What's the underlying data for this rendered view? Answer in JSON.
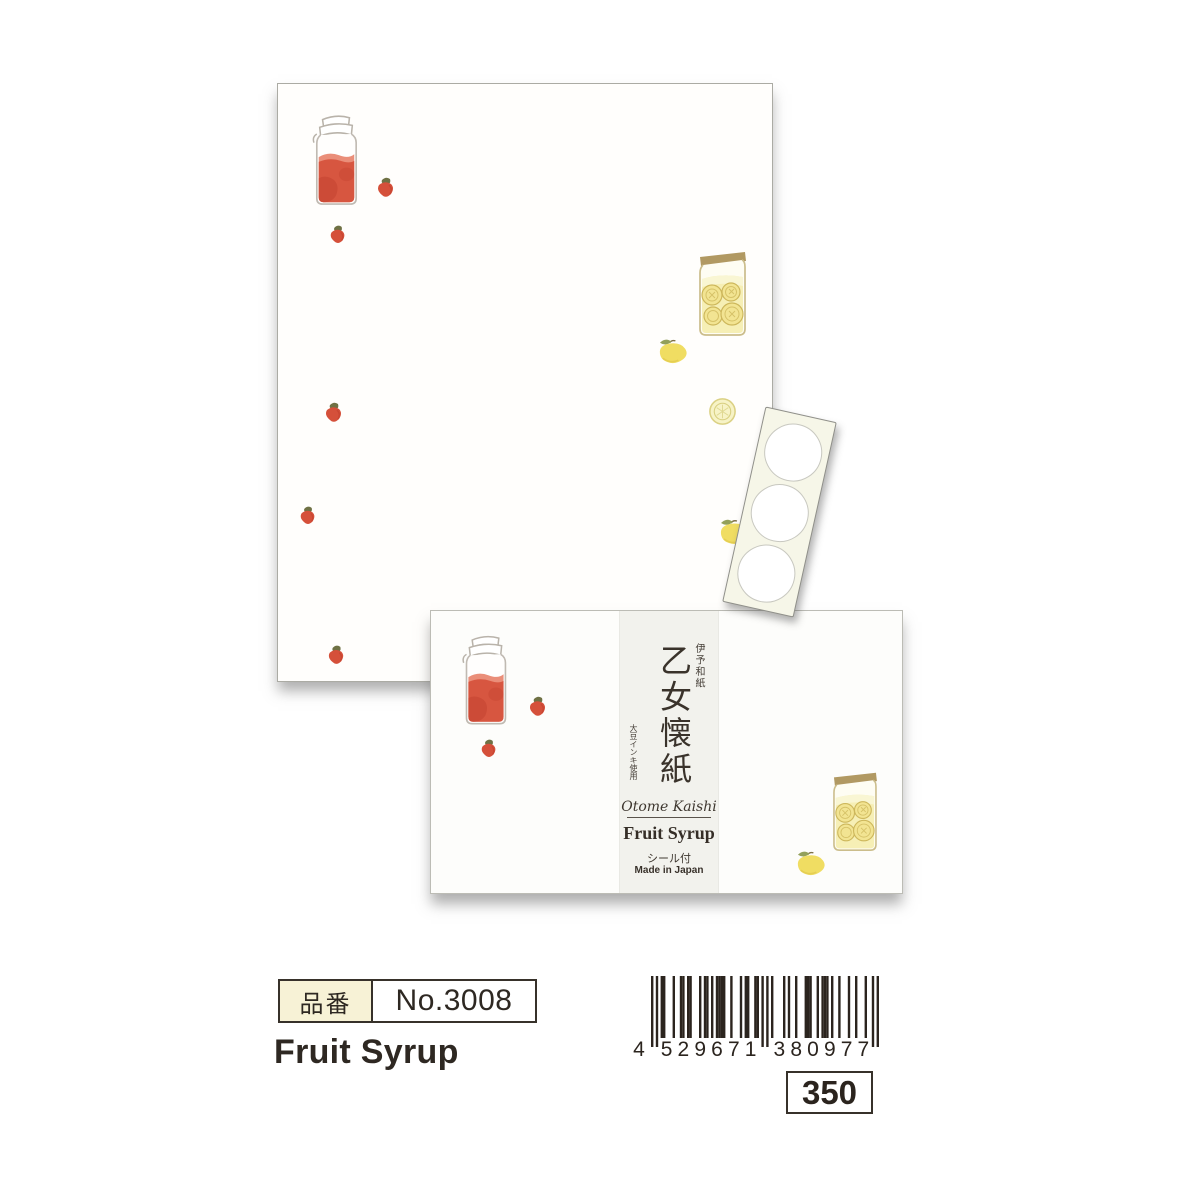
{
  "page": {
    "background": "#ffffff"
  },
  "colors": {
    "page_bg": "#ffffff",
    "red": "#d5503a",
    "red_deep": "#c13f2d",
    "red_light": "#e57258",
    "berry_leaf": "#6f7144",
    "lemon_yellow": "#f0dd62",
    "lemon_pale": "#f6efb5",
    "slice_yellow": "#f2e492",
    "slice_line": "#cdb75b",
    "leaf_green": "#93a05b",
    "lid_brown": "#aa9055",
    "jar_outline": "#b9b3aa",
    "ljar_outline": "#cbbd8b",
    "band_bg": "#f2f2ed",
    "cream": "#f7f2d6",
    "ink": "#2b241e",
    "text_dark": "#37302a"
  },
  "illustrations": {
    "strawberry_jar": "strawberry-syrup-jar",
    "lemon_jar": "lemon-syrup-jar",
    "strawberry": "strawberry",
    "lemon": "lemon",
    "lemon_slice": "lemon-slice",
    "sticker_strip": "round-sticker-strip"
  },
  "sticker_strip": {
    "sticker_count": 3
  },
  "package_band": {
    "paper_note": "伊予和紙",
    "title": "乙女懐紙",
    "ink_note": "大豆インキ使用",
    "romaji": "Otome Kaishi",
    "line_name": "Fruit Syrup",
    "seal_note": "シール付",
    "origin": "Made in Japan"
  },
  "info": {
    "item_label": "品番",
    "item_number": "No.3008",
    "product_name": "Fruit Syrup",
    "price": "350",
    "barcode_number": "4529671380977"
  }
}
